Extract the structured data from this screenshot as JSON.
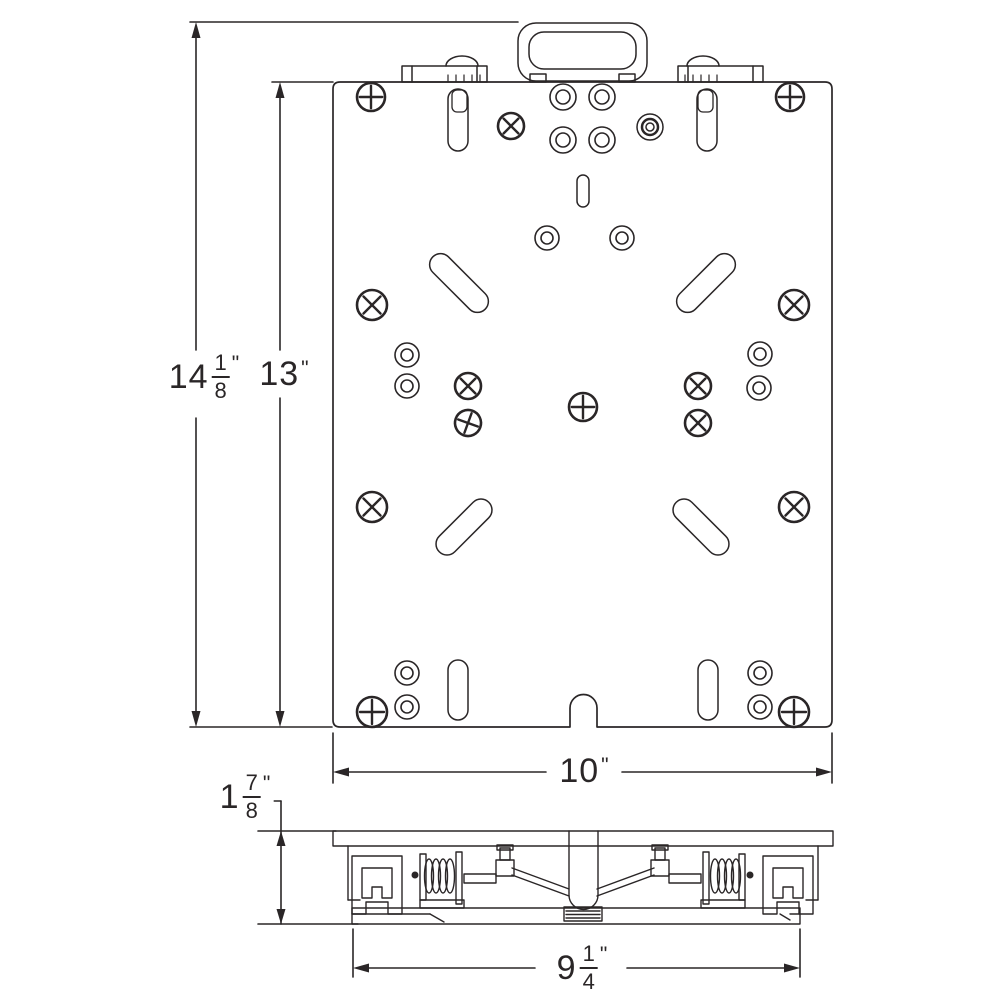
{
  "colors": {
    "line": "#2a2627",
    "background": "#ffffff"
  },
  "labels": {
    "overall_height": {
      "whole": "14",
      "num": "1",
      "den": "8",
      "prime": "\""
    },
    "plate_height": {
      "whole": "13",
      "prime": "\""
    },
    "plate_width": {
      "whole": "10",
      "prime": "\""
    },
    "side_height": {
      "whole": "1",
      "num": "7",
      "den": "8",
      "prime": "\""
    },
    "rail_width": {
      "whole": "9",
      "num": "1",
      "den": "4",
      "prime": "\""
    }
  },
  "features": {
    "phillips_screws": [
      {
        "x": 371,
        "y": 97,
        "r": 14,
        "rot": 0
      },
      {
        "x": 790,
        "y": 97,
        "r": 14,
        "rot": 0
      },
      {
        "x": 511,
        "y": 126,
        "r": 13,
        "rot": 45
      },
      {
        "x": 372,
        "y": 305,
        "r": 15,
        "rot": 45
      },
      {
        "x": 794,
        "y": 305,
        "r": 15,
        "rot": 45
      },
      {
        "x": 468,
        "y": 386,
        "r": 13,
        "rot": 45
      },
      {
        "x": 698,
        "y": 386,
        "r": 13,
        "rot": 45
      },
      {
        "x": 468,
        "y": 423,
        "r": 13,
        "rot": 20
      },
      {
        "x": 698,
        "y": 423,
        "r": 13,
        "rot": 45
      },
      {
        "x": 583,
        "y": 407,
        "r": 14,
        "rot": 0
      },
      {
        "x": 372,
        "y": 507,
        "r": 15,
        "rot": 45
      },
      {
        "x": 794,
        "y": 507,
        "r": 15,
        "rot": 45
      },
      {
        "x": 372,
        "y": 712,
        "r": 15,
        "rot": 0
      },
      {
        "x": 794,
        "y": 712,
        "r": 15,
        "rot": 0
      }
    ],
    "ring_holes": [
      {
        "x": 563,
        "y": 97,
        "ro": 13,
        "ri": 7
      },
      {
        "x": 602,
        "y": 97,
        "ro": 13,
        "ri": 7
      },
      {
        "x": 563,
        "y": 140,
        "ro": 13,
        "ri": 7
      },
      {
        "x": 602,
        "y": 140,
        "ro": 13,
        "ri": 7
      },
      {
        "x": 547,
        "y": 238,
        "ro": 12,
        "ri": 6
      },
      {
        "x": 622,
        "y": 238,
        "ro": 12,
        "ri": 6
      },
      {
        "x": 407,
        "y": 355,
        "ro": 12,
        "ri": 6
      },
      {
        "x": 407,
        "y": 386,
        "ro": 12,
        "ri": 6
      },
      {
        "x": 760,
        "y": 354,
        "ro": 12,
        "ri": 6
      },
      {
        "x": 759,
        "y": 388,
        "ro": 12,
        "ri": 6
      },
      {
        "x": 407,
        "y": 673,
        "ro": 12,
        "ri": 6
      },
      {
        "x": 407,
        "y": 707,
        "ro": 12,
        "ri": 6
      },
      {
        "x": 760,
        "y": 673,
        "ro": 12,
        "ri": 6
      },
      {
        "x": 760,
        "y": 707,
        "ro": 12,
        "ri": 6
      }
    ],
    "triple_ring_holes": [
      {
        "x": 650,
        "y": 127,
        "r1": 13,
        "r2": 8,
        "r3": 4
      }
    ],
    "capsule_slots": [
      {
        "cx": 458,
        "cy": 120,
        "len": 42,
        "w": 20,
        "angle": 90
      },
      {
        "cx": 707,
        "cy": 120,
        "len": 42,
        "w": 20,
        "angle": 90
      },
      {
        "cx": 583,
        "cy": 191,
        "len": 20,
        "w": 12,
        "angle": 90
      },
      {
        "cx": 459,
        "cy": 283,
        "len": 52,
        "w": 22,
        "angle": 45
      },
      {
        "cx": 706,
        "cy": 283,
        "len": 52,
        "w": 22,
        "angle": 135
      },
      {
        "cx": 464,
        "cy": 527,
        "len": 48,
        "w": 22,
        "angle": 135
      },
      {
        "cx": 701,
        "cy": 527,
        "len": 48,
        "w": 22,
        "angle": 45
      },
      {
        "cx": 458,
        "cy": 690,
        "len": 40,
        "w": 20,
        "angle": 90
      },
      {
        "cx": 708,
        "cy": 690,
        "len": 40,
        "w": 20,
        "angle": 90
      }
    ],
    "inner_tabs": [
      {
        "x": 452,
        "y": 90,
        "w": 15,
        "h": 22
      },
      {
        "x": 698,
        "y": 90,
        "w": 15,
        "h": 22
      }
    ]
  }
}
